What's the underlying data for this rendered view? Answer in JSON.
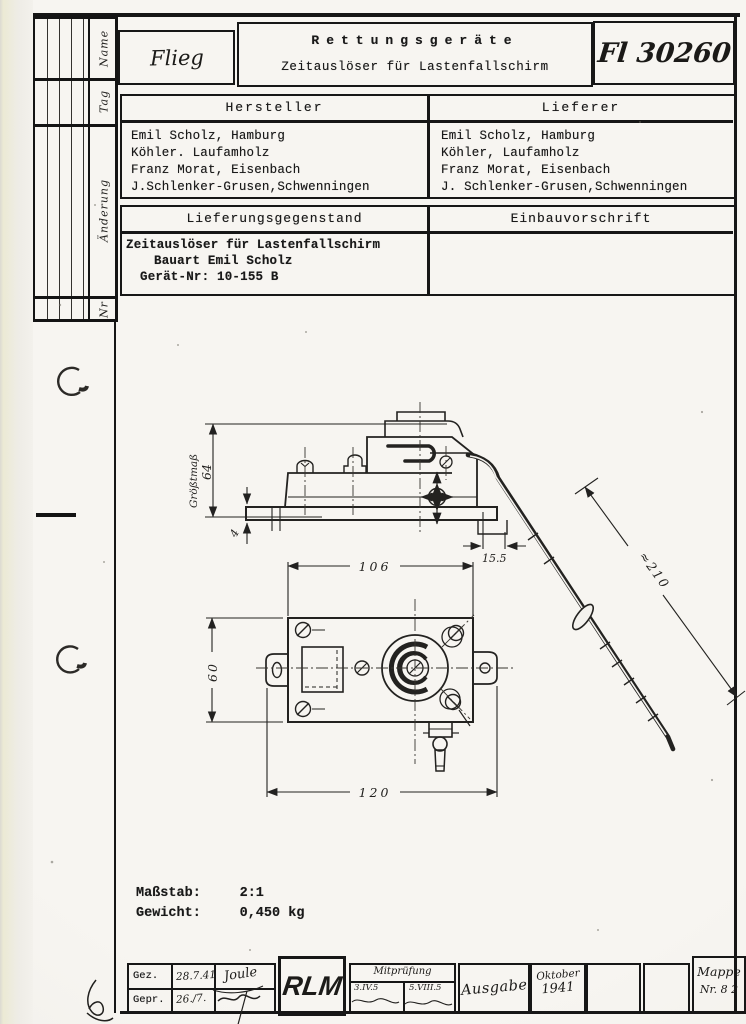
{
  "header": {
    "org": "Flieg",
    "category": "Rettungsgeräte",
    "subtitle": "Zeitauslöser für Lastenfallschirm",
    "doc_number": "Fl 30260"
  },
  "sidebar": {
    "labels": [
      "Name",
      "Tag",
      "Änderung",
      "Nr"
    ]
  },
  "supplier_table": {
    "col1_header": "Hersteller",
    "col2_header": "Lieferer",
    "col1_lines": [
      "Emil Scholz, Hamburg",
      "Köhler. Laufamholz",
      "Franz Morat, Eisenbach",
      "J.Schlenker-Grusen,Schwenningen"
    ],
    "col2_lines": [
      "Emil Scholz, Hamburg",
      "Köhler, Laufamholz",
      "Franz Morat, Eisenbach",
      "J. Schlenker-Grusen,Schwenningen"
    ]
  },
  "subject_table": {
    "col1_header": "Lieferungsgegenstand",
    "col2_header": "Einbauvorschrift",
    "col1_lines": [
      "Zeitauslöser für Lastenfallschirm",
      "Bauart Emil Scholz",
      "Gerät-Nr: 10-155 B"
    ]
  },
  "drawing": {
    "dim_height_label": "Größtmaß",
    "dim_height_value": "64",
    "dim_plate_thickness": "4",
    "dim_offset": "15.5",
    "dim_width_top": "106",
    "dim_cable_length": "≈210",
    "dim_depth": "60",
    "dim_width_bottom": "120",
    "scale_label": "Maßstab:",
    "scale_value": "2:1",
    "weight_label": "Gewicht:",
    "weight_value": "0,450 kg"
  },
  "footer": {
    "gez_label": "Gez.",
    "gez_date": "28.7.41",
    "gez_sig": "Joule",
    "gepr_label": "Gepr.",
    "gepr_date": "26./7.",
    "rlm": "RLM",
    "mitpruefung_label": "Mitprüfung",
    "mitpruefung_left": "3.IV.5",
    "mitpruefung_right": "5.VIII.5",
    "ausgabe_label": "Ausgabe",
    "issue_month": "Oktober",
    "issue_year": "1941",
    "mappe_label": "Mappe",
    "mappe_nr": "Nr. 8 2"
  }
}
